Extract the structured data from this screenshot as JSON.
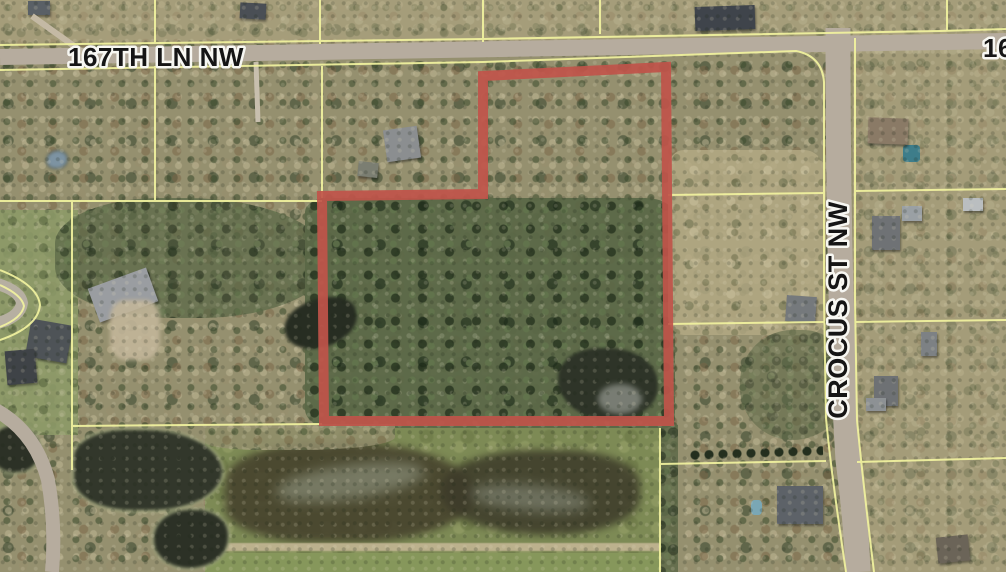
{
  "map": {
    "view_type": "aerial parcel viewer",
    "labels": {
      "street_horizontal": "167TH LN NW",
      "street_vertical": "CROCUS ST NW",
      "street_partial_right": "16"
    },
    "colors": {
      "selected_parcel_outline": "#c0544a",
      "parcel_lines": "#f2f39f",
      "road": "#b6ac9e"
    }
  }
}
